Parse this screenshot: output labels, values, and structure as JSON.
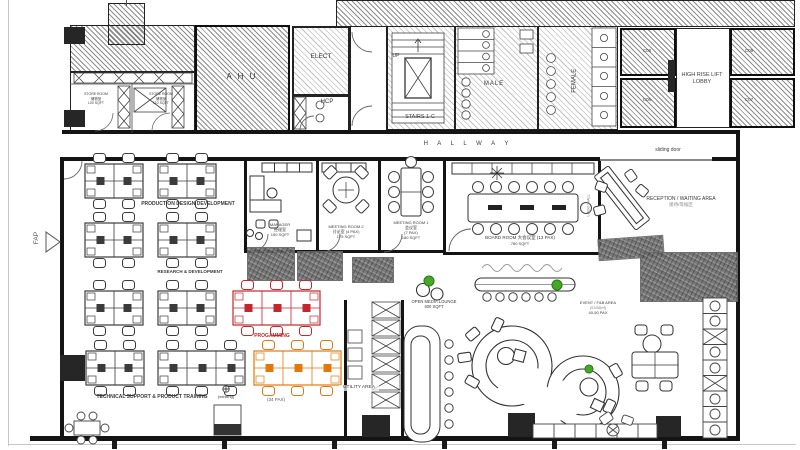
{
  "colors": {
    "black": "#3b3b3b",
    "red": "#c1272d",
    "orange": "#e2790f",
    "green": "#46a926",
    "wall": "#141414"
  },
  "core": {
    "ahu": "A H U",
    "elect": "ELECT",
    "hcp": "HCP",
    "up": "UP",
    "stairs": "STAIRS 1-C",
    "male": "MALE",
    "female": "FEMALE",
    "lift_lobby": "HIGH RISE LIFT LOBBY",
    "lifts": {
      "c08": "C08",
      "c06": "C06",
      "c05": "C05",
      "c07": "C07"
    },
    "store_room_1": {
      "l1": "STORE ROOM",
      "l2": "储物室",
      "l3": "100 SQFT"
    },
    "store_room_2": {
      "l1": "STORE ROOM",
      "l2": "储物室",
      "l3": "110 SQFT"
    }
  },
  "circulation": {
    "hallway": "H A L L W A Y",
    "sliding_door": "sliding door",
    "fap": "FAP"
  },
  "rooms": {
    "manager": {
      "name": "MANAGER",
      "cn": "经理室",
      "size": "150 SQFT"
    },
    "meeting2": {
      "name": "MEETING ROOM 2",
      "cn": "讨论室 (4 PAX)",
      "size": "175 SQFT"
    },
    "meeting1": {
      "name": "MEETING ROOM 1",
      "cn": "会议室",
      "pax": "(7 PAX)",
      "size": "180 SQFT"
    },
    "board": {
      "name": "BOARD ROOM 大会议室 (13 PAX)",
      "size": "780 SQFT"
    },
    "reception": {
      "name": "RECEPTION / WAITING AREA",
      "cn": "接待/等候区"
    },
    "logo_wall": "LOGO WALL",
    "utility": "UTILITY AREA"
  },
  "zones": {
    "production": "PRODUCTION DESIGN DEVELOPMENT",
    "rnd": "RESEARCH & DEVELOPMENT",
    "tech": "TECHNICAL SUPPORT & PRODUCT TRAINING",
    "programming": "PROGAMMING",
    "programming_pax": "(34 PAX)",
    "existing": "(existing)",
    "lounge": {
      "name": "OPEN MEDIA LOUNGE",
      "size": "400 SQFT"
    },
    "fnb": {
      "name": "EVENT / F&B AREA",
      "size": "(53/88㎡)",
      "pax": "40-50 PAX"
    }
  },
  "workstations": {
    "clusters": [
      {
        "x": 85,
        "y": 164,
        "cols": 2,
        "color": "black"
      },
      {
        "x": 158,
        "y": 164,
        "cols": 2,
        "color": "black"
      },
      {
        "x": 85,
        "y": 223,
        "cols": 2,
        "color": "black"
      },
      {
        "x": 158,
        "y": 223,
        "cols": 2,
        "color": "black"
      },
      {
        "x": 85,
        "y": 291,
        "cols": 2,
        "color": "black"
      },
      {
        "x": 158,
        "y": 291,
        "cols": 2,
        "color": "black"
      },
      {
        "x": 233,
        "y": 291,
        "cols": 3,
        "color": "red"
      },
      {
        "x": 86,
        "y": 351,
        "cols": 2,
        "color": "black"
      },
      {
        "x": 158,
        "y": 351,
        "cols": 3,
        "color": "black"
      },
      {
        "x": 254,
        "y": 351,
        "cols": 3,
        "color": "orange"
      }
    ]
  }
}
